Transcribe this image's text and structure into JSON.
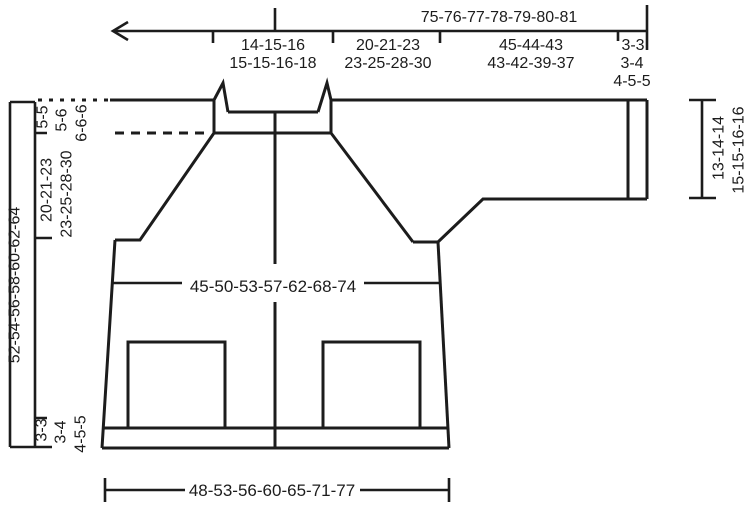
{
  "diagram": {
    "colors": {
      "line": "#1c1c1c",
      "background": "#ffffff"
    },
    "top_ruler": {
      "total": "75-76-77-78-79-80-81",
      "segments": [
        {
          "rows": [
            "14-15-16",
            "15-15-16-18"
          ]
        },
        {
          "rows": [
            "20-21-23",
            "23-25-28-30"
          ]
        },
        {
          "rows": [
            "45-44-43",
            "43-42-39-37"
          ]
        },
        {
          "rows": [
            "3-3",
            "3-4",
            "4-5-5"
          ]
        }
      ]
    },
    "left_ruler": {
      "total": "52-54-56-58-60-62-64",
      "neckband": [
        "5-5",
        "5-6",
        "6-6-6"
      ],
      "yoke": [
        "20-21-23",
        "23-25-28-30"
      ],
      "bottom_band": [
        "3-3",
        "3-4",
        "4-5-5"
      ]
    },
    "right_ruler": {
      "rows": [
        "13-14-14",
        "15-15-16-16"
      ]
    },
    "chest_width": "45-50-53-57-62-68-74",
    "bottom_width": "48-53-56-60-65-71-77"
  }
}
